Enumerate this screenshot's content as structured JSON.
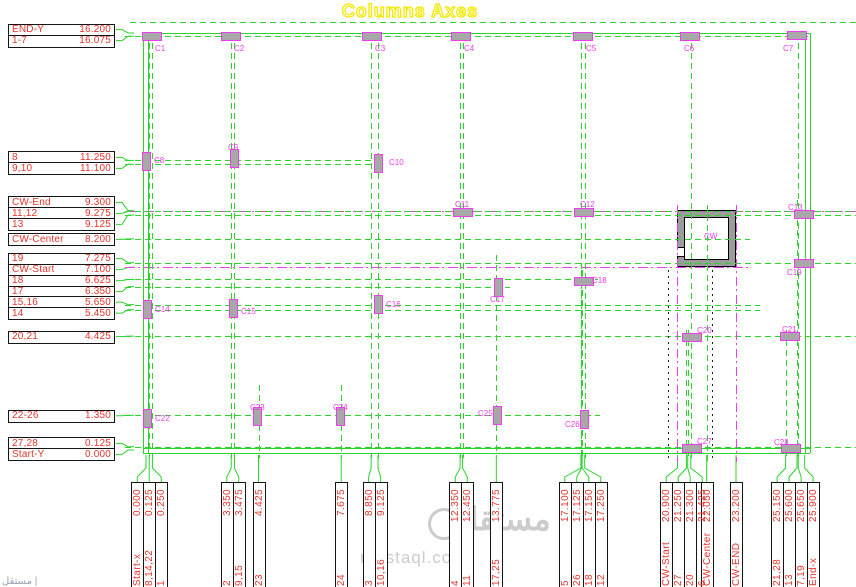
{
  "title": "Columns Axes",
  "colors": {
    "green": "#2bd32b",
    "magenta": "#ee3cee",
    "red": "#e8332b",
    "yellow": "#f2e800",
    "column_fill": "#a8a8a8",
    "watermark": "#cccccc"
  },
  "watermark": {
    "arabic": "مستقل",
    "domain": "mostaql.com",
    "corner": "مستقل |"
  },
  "core_wall": {
    "label": "CW"
  },
  "y_axis": {
    "groups": [
      {
        "rows": [
          {
            "label": "END-Y",
            "value": "16.200",
            "line": "none"
          },
          {
            "label": "1-7",
            "value": "16.075",
            "line": "g",
            "x1": 125,
            "x2": 808
          }
        ]
      },
      {
        "rows": [
          {
            "label": "8",
            "value": "11.250",
            "line": "g",
            "x1": 125,
            "x2": 385
          },
          {
            "label": "9,10",
            "value": "11.100",
            "line": "g",
            "x1": 125,
            "x2": 385
          }
        ]
      },
      {
        "rows": [
          {
            "label": "CW-End",
            "value": "9.300",
            "line": "m",
            "x1": 125,
            "x2": 856
          },
          {
            "label": "11,12",
            "value": "9.275",
            "line": "g",
            "x1": 125,
            "x2": 856
          },
          {
            "label": "13",
            "value": "9.125",
            "line": "g",
            "x1": 125,
            "x2": 856
          }
        ]
      },
      {
        "rows": [
          {
            "label": "CW-Center",
            "value": "8.200",
            "line": "g",
            "x1": 125,
            "x2": 750
          }
        ]
      },
      {
        "rows": [
          {
            "label": "19",
            "value": "7.275",
            "line": "g",
            "x1": 125,
            "x2": 856
          },
          {
            "label": "CW-Start",
            "value": "7.100",
            "line": "m",
            "x1": 125,
            "x2": 750
          },
          {
            "label": "18",
            "value": "6.625",
            "line": "g",
            "x1": 125,
            "x2": 598
          },
          {
            "label": "17",
            "value": "6.350",
            "line": "g",
            "x1": 125,
            "x2": 510
          }
        ]
      },
      {
        "rows": [
          {
            "label": "15,16",
            "value": "5.650",
            "line": "g",
            "x1": 125,
            "x2": 760
          },
          {
            "label": "14",
            "value": "5.450",
            "line": "g",
            "x1": 125,
            "x2": 760
          }
        ]
      },
      {
        "rows": [
          {
            "label": "20,21",
            "value": "4.425",
            "line": "g",
            "x1": 125,
            "x2": 856
          }
        ]
      },
      {
        "rows": [
          {
            "label": "22-26",
            "value": "1.350",
            "line": "g",
            "x1": 125,
            "x2": 600
          }
        ]
      },
      {
        "rows": [
          {
            "label": "27,28",
            "value": "0.125",
            "line": "g",
            "x1": 125,
            "x2": 856
          },
          {
            "label": "Start-Y",
            "value": "0.000",
            "line": "none"
          }
        ]
      }
    ]
  },
  "x_axis": {
    "groups": [
      {
        "rows": [
          {
            "label": "Start-x",
            "value": "0.000",
            "line": "none"
          },
          {
            "label": "8,14,22",
            "value": "0.125",
            "line": "g",
            "y1": 33,
            "y2": 458
          },
          {
            "label": "1",
            "value": "0.250",
            "line": "g",
            "y1": 33,
            "y2": 458
          }
        ]
      },
      {
        "rows": [
          {
            "label": "2",
            "value": "3.350",
            "line": "g",
            "y1": 33,
            "y2": 458
          },
          {
            "label": "9,15",
            "value": "3.475",
            "line": "g",
            "y1": 33,
            "y2": 458
          }
        ]
      },
      {
        "rows": [
          {
            "label": "23",
            "value": "4.425",
            "line": "g",
            "y1": 385,
            "y2": 458
          }
        ]
      },
      {
        "rows": [
          {
            "label": "24",
            "value": "7.675",
            "line": "g",
            "y1": 385,
            "y2": 458
          }
        ]
      },
      {
        "rows": [
          {
            "label": "3",
            "value": "8.850",
            "line": "g",
            "y1": 33,
            "y2": 458
          },
          {
            "label": "10,16",
            "value": "9.125",
            "line": "g",
            "y1": 33,
            "y2": 458
          }
        ]
      },
      {
        "rows": [
          {
            "label": "4",
            "value": "12.350",
            "line": "g",
            "y1": 33,
            "y2": 458
          },
          {
            "label": "11",
            "value": "12.450",
            "line": "g",
            "y1": 33,
            "y2": 458
          }
        ]
      },
      {
        "rows": [
          {
            "label": "17,25",
            "value": "13.775",
            "line": "g",
            "y1": 255,
            "y2": 458
          }
        ]
      },
      {
        "rows": [
          {
            "label": "5",
            "value": "17.100",
            "line": "g",
            "y1": 33,
            "y2": 458
          },
          {
            "label": "26",
            "value": "17.125",
            "line": "g",
            "y1": 270,
            "y2": 458
          },
          {
            "label": "18",
            "value": "17.150",
            "line": "g",
            "y1": 270,
            "y2": 458
          },
          {
            "label": "12",
            "value": "17.250",
            "line": "g",
            "y1": 33,
            "y2": 458
          }
        ]
      },
      {
        "rows": [
          {
            "label": "CW-Start",
            "value": "20.900",
            "line": "m",
            "y1": 205,
            "y2": 462
          },
          {
            "label": "27",
            "value": "21.250",
            "line": "g",
            "y1": 330,
            "y2": 458
          },
          {
            "label": "20",
            "value": "21.300",
            "line": "g",
            "y1": 330,
            "y2": 458
          },
          {
            "label": "6",
            "value": "21.425",
            "line": "g",
            "y1": 33,
            "y2": 458
          }
        ]
      },
      {
        "rows": [
          {
            "label": "CW-Center",
            "value": "22.050",
            "line": "g",
            "y1": 205,
            "y2": 462
          }
        ]
      },
      {
        "rows": [
          {
            "label": "CW-END",
            "value": "23.200",
            "line": "m",
            "y1": 205,
            "y2": 462
          }
        ]
      },
      {
        "rows": [
          {
            "label": "21,28",
            "value": "25.150",
            "line": "g",
            "y1": 330,
            "y2": 458
          },
          {
            "label": "13",
            "value": "25.600",
            "line": "g",
            "y1": 200,
            "y2": 458
          },
          {
            "label": "7,19",
            "value": "25.650",
            "line": "g",
            "y1": 33,
            "y2": 458
          },
          {
            "label": "End-x",
            "value": "25.900",
            "line": "none"
          }
        ]
      }
    ]
  },
  "columns": [
    {
      "id": "C1",
      "x": 152,
      "y": 36,
      "o": "h",
      "lx": 155,
      "ly": 45
    },
    {
      "id": "C2",
      "x": 231,
      "y": 36,
      "o": "h",
      "lx": 234,
      "ly": 45
    },
    {
      "id": "C3",
      "x": 372,
      "y": 36,
      "o": "h",
      "lx": 375,
      "ly": 45
    },
    {
      "id": "C4",
      "x": 461,
      "y": 36,
      "o": "h",
      "lx": 464,
      "ly": 45
    },
    {
      "id": "C5",
      "x": 583,
      "y": 36,
      "o": "h",
      "lx": 586,
      "ly": 45
    },
    {
      "id": "C6",
      "x": 690,
      "y": 36,
      "o": "h",
      "lx": 684,
      "ly": 45
    },
    {
      "id": "C7",
      "x": 797,
      "y": 35,
      "o": "h",
      "lx": 783,
      "ly": 45
    },
    {
      "id": "C8",
      "x": 146,
      "y": 161,
      "o": "v",
      "lx": 154,
      "ly": 157
    },
    {
      "id": "C9",
      "x": 234,
      "y": 158,
      "o": "v",
      "lx": 228,
      "ly": 144
    },
    {
      "id": "C10",
      "x": 378,
      "y": 163,
      "o": "v",
      "lx": 389,
      "ly": 159
    },
    {
      "id": "C11",
      "x": 463,
      "y": 212,
      "o": "h",
      "lx": 455,
      "ly": 201
    },
    {
      "id": "C12",
      "x": 584,
      "y": 212,
      "o": "h",
      "lx": 580,
      "ly": 201
    },
    {
      "id": "C13",
      "x": 804,
      "y": 214,
      "o": "h",
      "lx": 788,
      "ly": 204
    },
    {
      "id": "C14",
      "x": 147,
      "y": 309,
      "o": "v",
      "lx": 155,
      "ly": 306
    },
    {
      "id": "C15",
      "x": 233,
      "y": 308,
      "o": "v",
      "lx": 241,
      "ly": 308
    },
    {
      "id": "C16",
      "x": 378,
      "y": 304,
      "o": "v",
      "lx": 386,
      "ly": 301
    },
    {
      "id": "C17",
      "x": 498,
      "y": 287,
      "o": "v",
      "lx": 490,
      "ly": 296
    },
    {
      "id": "C18",
      "x": 584,
      "y": 281,
      "o": "h",
      "lx": 592,
      "ly": 277
    },
    {
      "id": "C19",
      "x": 804,
      "y": 263,
      "o": "h",
      "lx": 787,
      "ly": 269
    },
    {
      "id": "C20",
      "x": 692,
      "y": 337,
      "o": "h",
      "lx": 697,
      "ly": 327
    },
    {
      "id": "C21",
      "x": 790,
      "y": 336,
      "o": "h",
      "lx": 782,
      "ly": 326
    },
    {
      "id": "C22",
      "x": 147,
      "y": 418,
      "o": "v",
      "lx": 155,
      "ly": 415
    },
    {
      "id": "C23",
      "x": 257,
      "y": 416,
      "o": "v",
      "lx": 250,
      "ly": 404
    },
    {
      "id": "C24",
      "x": 340,
      "y": 416,
      "o": "v",
      "lx": 333,
      "ly": 404
    },
    {
      "id": "C25",
      "x": 497,
      "y": 415,
      "o": "v",
      "lx": 478,
      "ly": 410
    },
    {
      "id": "C26",
      "x": 584,
      "y": 419,
      "o": "v",
      "lx": 565,
      "ly": 421
    },
    {
      "id": "C27",
      "x": 692,
      "y": 448,
      "o": "h",
      "lx": 697,
      "ly": 438
    },
    {
      "id": "C28",
      "x": 791,
      "y": 448,
      "o": "h",
      "lx": 774,
      "ly": 439
    }
  ]
}
